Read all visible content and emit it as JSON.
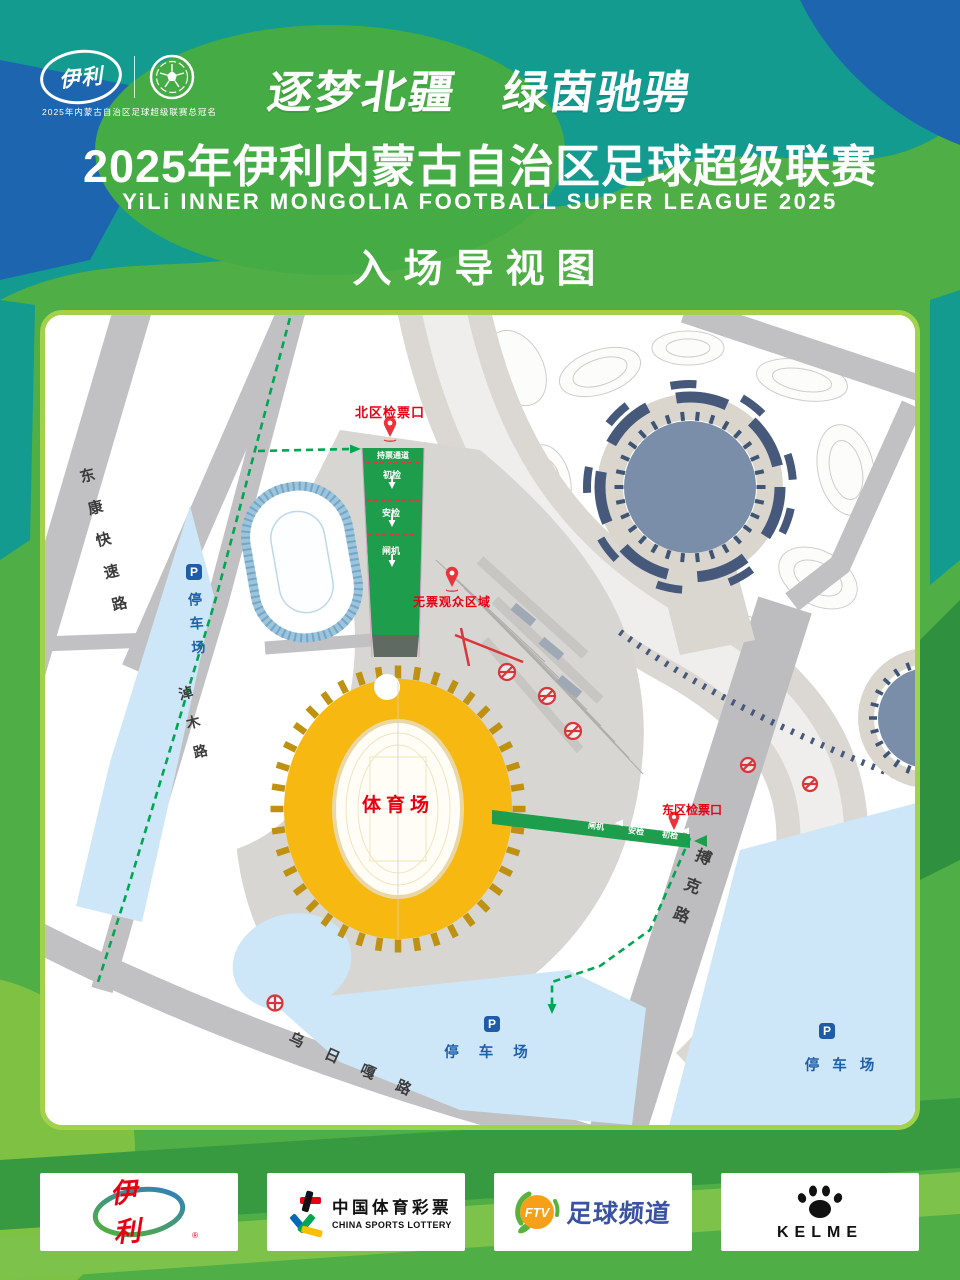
{
  "header": {
    "yili_logo_text": "伊利",
    "sponsor_note": "2025年内蒙古自治区足球超级联赛总冠名",
    "slogan": "逐梦北疆　绿茵驰骋",
    "title": "2025年伊利内蒙古自治区足球超级联赛",
    "title_en": "YiLi INNER MONGOLIA FOOTBALL SUPER LEAGUE 2025",
    "map_heading": "入场导视图"
  },
  "map": {
    "roads": {
      "dongkang": "东康快速路",
      "naomu": "淖木路",
      "boke": "搏克路",
      "wuriga": "乌日嘎路"
    },
    "stadium_label": "体育场",
    "gates": {
      "north": "北区检票口",
      "east": "东区检票口"
    },
    "no_ticket_area": "无票观众区域",
    "parking_label": "停车场",
    "parking_icon": "P",
    "north_flow": {
      "channel": "持票通道",
      "step1": "初检",
      "step2": "安检",
      "step3": "闸机"
    },
    "east_flow": {
      "step3": "闸机",
      "step2": "安检",
      "step1": "初检"
    }
  },
  "sponsors": {
    "yili": {
      "name": "伊利"
    },
    "lottery": {
      "name": "中国体育彩票",
      "name_en": "CHINA SPORTS LOTTERY"
    },
    "ftv": {
      "abbr": "FTV",
      "name": "足球频道"
    },
    "kelme": {
      "name": "KELME"
    }
  },
  "colors": {
    "teal": "#139B90",
    "green": "#4FAE45",
    "blue": "#1D66AF",
    "map_border": "#A2D24C",
    "stadium_gold": "#F8B812",
    "route_green": "#00A651",
    "corridor_green": "#1E9E4C",
    "alert_red": "#E60012",
    "parking_blue": "#CDE7F8",
    "parking_text": "#1F5FA8",
    "road_gray": "#C1C1C3"
  }
}
